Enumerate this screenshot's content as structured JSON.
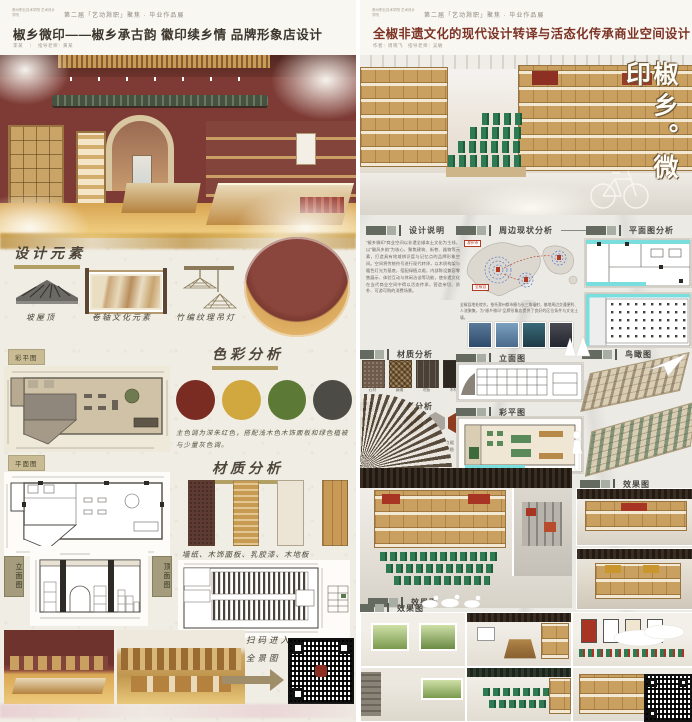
{
  "shared": {
    "event_line": "第二届「艺动滁职」聚焦 · 毕业作品展",
    "school_mark": "滁州职业技术学院 艺术设计学院"
  },
  "left_poster": {
    "title": "椒乡微印——椒乡承古韵 徽印续乡情 品牌形象店设计",
    "byline": "李某　｜　指导老师：黄某",
    "sections": {
      "design_elements": "设计元素",
      "color_analysis": "色彩分析",
      "material_analysis": "材质分析",
      "color_plan": "彩平图",
      "floor_plan": "平面图",
      "elevation": "立面图",
      "ceiling_plan": "顶面图"
    },
    "elements": [
      {
        "caption": "坡屋顶"
      },
      {
        "caption": "卷轴文化元素"
      },
      {
        "caption": "竹编纹理吊灯"
      }
    ],
    "palette": [
      "#7a2b22",
      "#d0a83f",
      "#5c7a35",
      "#4c4b45"
    ],
    "color_text": "主色调为深朱红色，搭配浅木色木饰面板和绿色植被与少量灰色调。",
    "material_colors": [
      "#5d3a32",
      "#c79b52",
      "#ece5d6",
      "#c89a55"
    ],
    "materials_caption": "墙纸、木饰面板、乳胶漆、木地板",
    "qr_line1": "扫码进入",
    "qr_line2": "全景图"
  },
  "right_poster": {
    "title": "全椒非遗文化的现代设计转译与活态化传承商业空间设计",
    "byline": "作者：周晓飞　指导老师：吴敏",
    "hero_calligraphy": "椒乡。微印",
    "sections": {
      "design_note": "设计说明",
      "surrounding": "周边现状分析",
      "plan_analysis": "平面图分析",
      "material_analysis": "材质分析",
      "color_analysis": "色彩分析",
      "elevation": "立面图",
      "color_plan": "彩平图",
      "birdseye": "鸟瞰图",
      "render": "效果图"
    },
    "design_note_text": "“椒乡微印”商业空间以非遗全椒本土文化为主线，以“徽风乡韵”为核心，聚焦建筑、街巷、器物等元素，打造具有地域辨识度与记忆点的品牌形象空间。空间将传统符号进行现代转译，以木质构架与暖色灯光为基底，搭配绿植点缀，内部陈设兼容零售展示、体验互动与休闲洽谈等功能，使非遗文化在当代商业空间中得以活态传承，营造亲切、质朴、可游可购的消费场景。",
    "surrounding_text": "全椒县地处皖东，依托滁州都市圈与长三角辐射，基地周边交通便利、人流聚集，为“椒乡微印”品牌形象店提供了良好的区位条件与文化土壤。",
    "map_labels": [
      "全椒县",
      "滁州市"
    ],
    "materials": [
      {
        "label": "石材",
        "color": "#6e5b4a"
      },
      {
        "label": "藤编",
        "color": "#7a5c36"
      },
      {
        "label": "地板",
        "color": "#4a4036"
      },
      {
        "label": "木材",
        "color": "#2e2620"
      }
    ],
    "hex_palette": [
      "#9c8c6c",
      "#bcb8b0",
      "#6e4c34",
      "#aaa69e",
      "#8e3c20"
    ],
    "color_text": "以原木色为主调，搭配灰白石材与藤编材质，点缀砖红与墨绿，呼应非遗文化的质朴底色，塑造沉稳而富有活力的商业氛围。"
  }
}
